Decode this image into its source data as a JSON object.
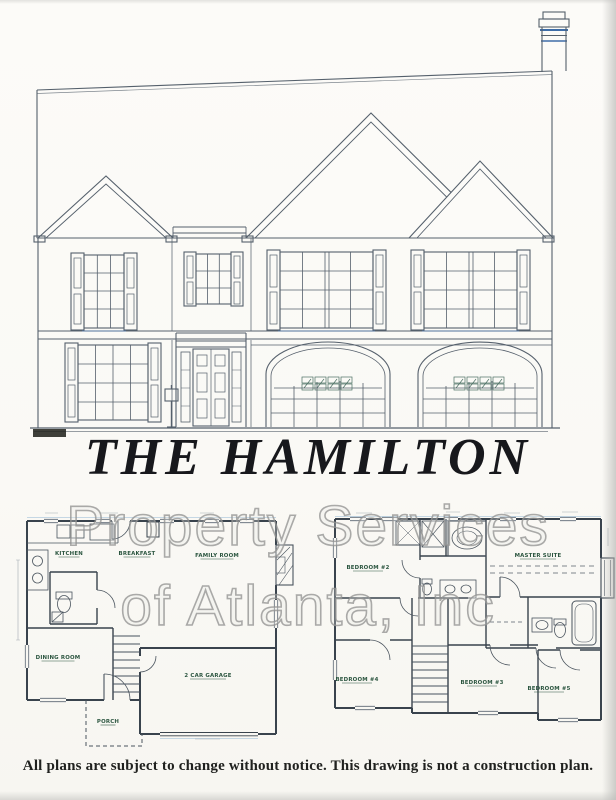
{
  "doc": {
    "plan_title": "THE HAMILTON",
    "watermark_line1": "Property Services",
    "watermark_line2": "of Atlanta, Inc",
    "disclaimer": "All plans are subject to change without notice. This drawing is not a construction plan."
  },
  "first_floor_plan": {
    "rooms": [
      "KITCHEN",
      "BREAKFAST",
      "FAMILY ROOM",
      "DINING ROOM",
      "2 CAR GARAGE",
      "PORCH"
    ]
  },
  "second_floor_plan": {
    "rooms": [
      "BEDROOM #2",
      "MASTER SUITE",
      "BEDROOM #4",
      "BEDROOM #3",
      "BEDROOM #5"
    ]
  }
}
